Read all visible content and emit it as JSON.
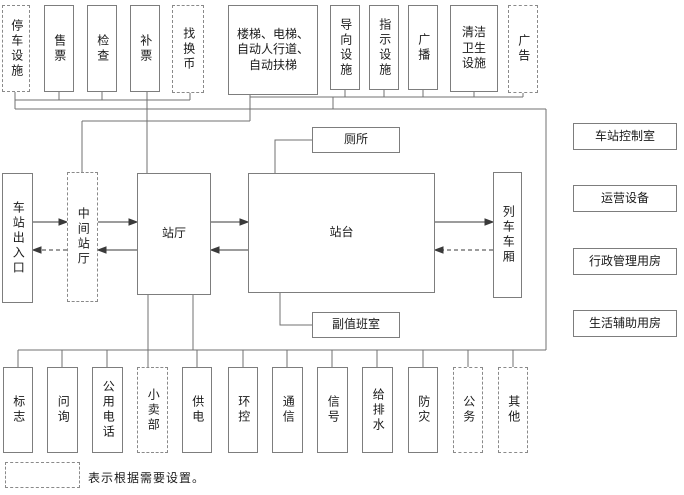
{
  "diagram": {
    "kind": "station functional relationship diagram",
    "boxes": [
      {
        "id": "parking_facilities",
        "label": "停车设施",
        "dashed": true
      },
      {
        "id": "ticket_sales",
        "label": "售票",
        "dashed": false
      },
      {
        "id": "ticket_check",
        "label": "检查",
        "dashed": false
      },
      {
        "id": "fare_adjustment",
        "label": "补票",
        "dashed": false
      },
      {
        "id": "change_money",
        "label": "找换币",
        "dashed": true
      },
      {
        "id": "stairs_escalators",
        "label": "楼梯、电梯、自动人行道、自动扶梯",
        "dashed": false
      },
      {
        "id": "guidance_facilities",
        "label": "导向设施",
        "dashed": false
      },
      {
        "id": "sign_facilities",
        "label": "指示设施",
        "dashed": false
      },
      {
        "id": "broadcast",
        "label": "广播",
        "dashed": false
      },
      {
        "id": "cleaning_facilities",
        "label": "清洁卫生设施",
        "dashed": false
      },
      {
        "id": "advertising",
        "label": "广告",
        "dashed": true
      },
      {
        "id": "station_entrance_exit",
        "label": "车站出入口",
        "dashed": false
      },
      {
        "id": "intermediate_concourse",
        "label": "中间站厅",
        "dashed": true
      },
      {
        "id": "concourse",
        "label": "站厅",
        "dashed": false
      },
      {
        "id": "platform",
        "label": "站台",
        "dashed": false
      },
      {
        "id": "toilet",
        "label": "厕所",
        "dashed": false
      },
      {
        "id": "deputy_duty_room",
        "label": "副值班室",
        "dashed": false
      },
      {
        "id": "train_cars",
        "label": "列车车厢",
        "dashed": false
      },
      {
        "id": "station_control_room",
        "label": "车站控制室",
        "dashed": false
      },
      {
        "id": "operation_equipment",
        "label": "运营设备",
        "dashed": false
      },
      {
        "id": "admin_rooms",
        "label": "行政管理用房",
        "dashed": false
      },
      {
        "id": "living_auxiliary_rooms",
        "label": "生活辅助用房",
        "dashed": false
      },
      {
        "id": "signage",
        "label": "标志",
        "dashed": false
      },
      {
        "id": "information",
        "label": "问询",
        "dashed": false
      },
      {
        "id": "public_phone",
        "label": "公用电话",
        "dashed": false
      },
      {
        "id": "kiosk",
        "label": "小卖部",
        "dashed": true
      },
      {
        "id": "power_supply",
        "label": "供电",
        "dashed": false
      },
      {
        "id": "environment_control",
        "label": "环控",
        "dashed": false
      },
      {
        "id": "communication",
        "label": "通信",
        "dashed": false
      },
      {
        "id": "signal",
        "label": "信号",
        "dashed": false
      },
      {
        "id": "water_drainage",
        "label": "给排水",
        "dashed": false
      },
      {
        "id": "disaster_prevention",
        "label": "防灾",
        "dashed": false
      },
      {
        "id": "official_business",
        "label": "公务",
        "dashed": true
      },
      {
        "id": "others",
        "label": "其他",
        "dashed": true
      }
    ],
    "legend": {
      "note": "表示根据需要设置。"
    },
    "colors": {
      "line": "#707070",
      "arrow": "#3a3a3a",
      "border": "#7d7d7d",
      "background": "#ffffff"
    }
  }
}
